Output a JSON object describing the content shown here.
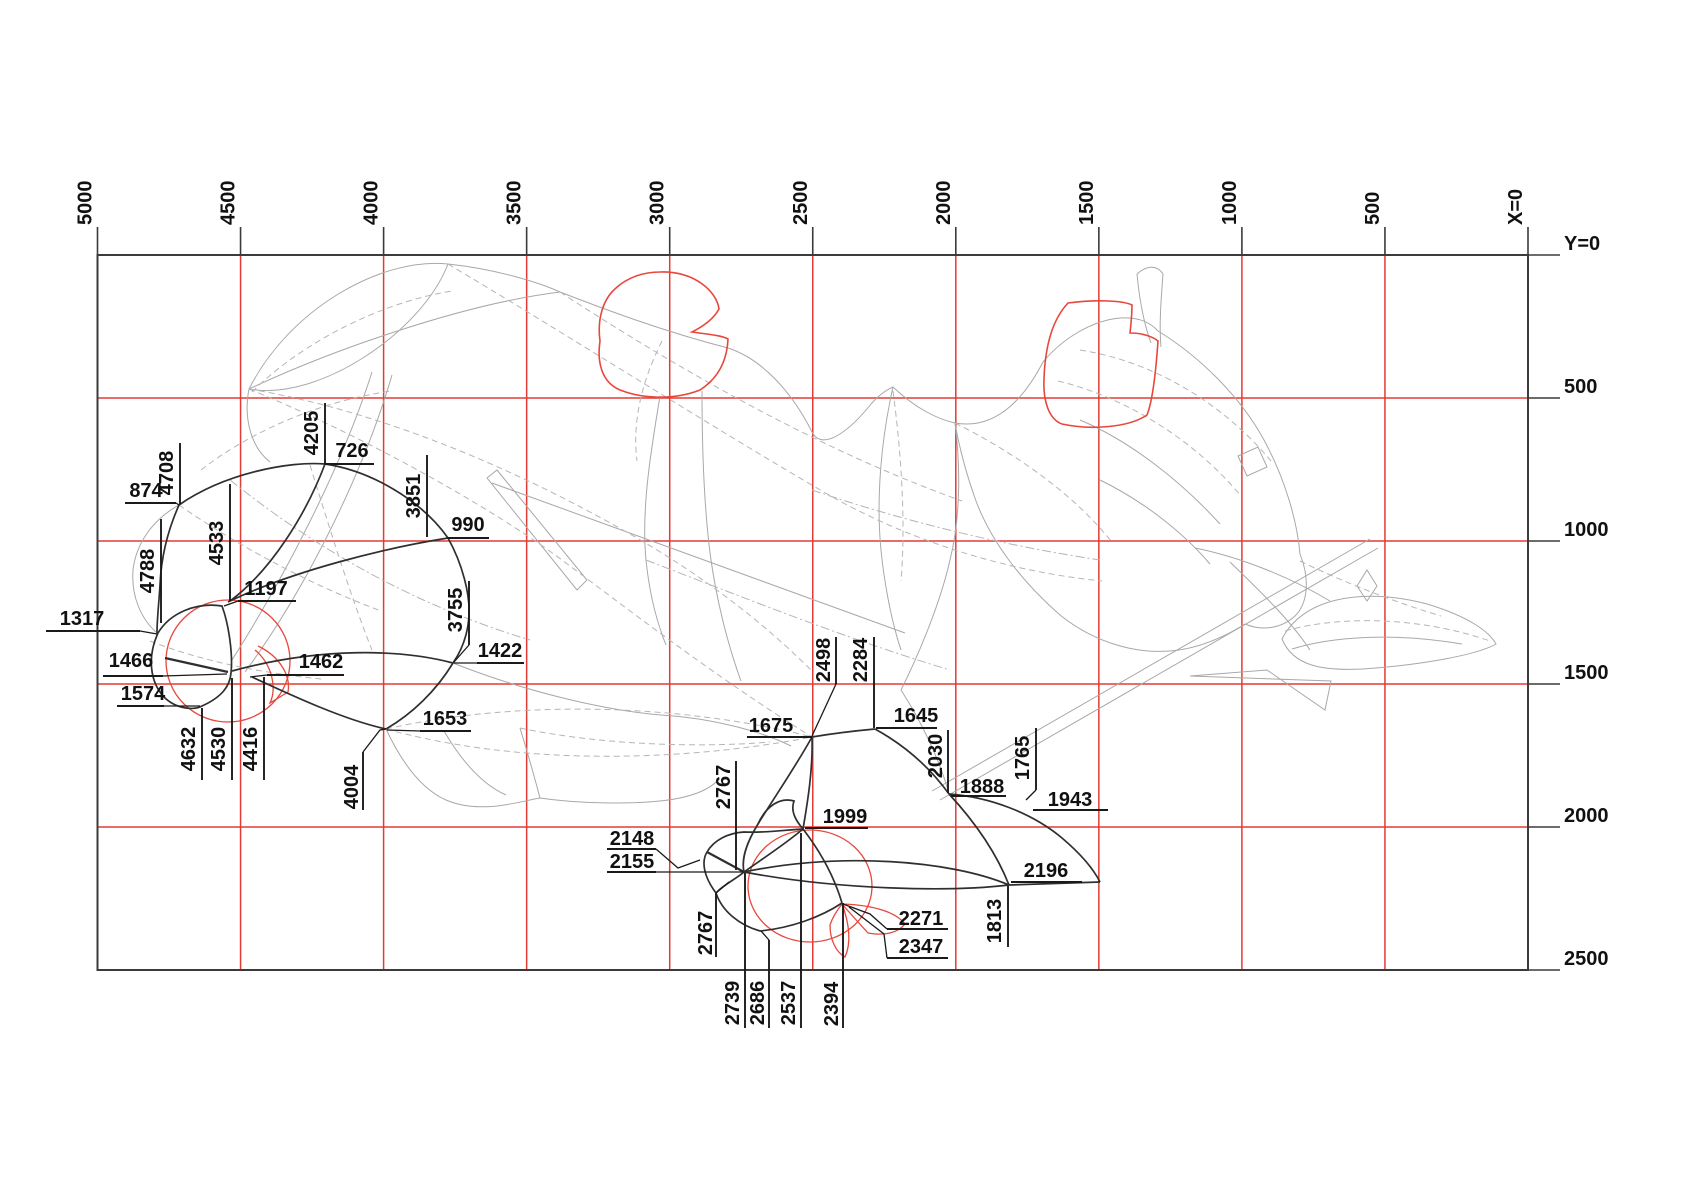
{
  "title": "CAD wireframe dimension drawing of reclining bull sculpture with coordinate grid",
  "axes": {
    "x_axis": {
      "zero_label": "X=0",
      "ticks": [
        "5000",
        "4500",
        "4000",
        "3500",
        "3000",
        "2500",
        "2000",
        "1500",
        "1000",
        "500",
        "X=0"
      ]
    },
    "y_axis": {
      "zero_label": "Y=0",
      "ticks": [
        "Y=0",
        "500",
        "1000",
        "1500",
        "2000",
        "2500"
      ]
    }
  },
  "grid": {
    "cols": 10,
    "rows": 5,
    "origin_x": 97.5,
    "origin_y": 255,
    "cell_w": 143.05,
    "cell_h": 143,
    "red_cells": [
      [
        1,
        0
      ],
      [
        3,
        0
      ],
      [
        5,
        0
      ],
      [
        7,
        0
      ],
      [
        9,
        0
      ],
      [
        0,
        1
      ],
      [
        2,
        1
      ],
      [
        4,
        1
      ],
      [
        6,
        1
      ],
      [
        8,
        1
      ],
      [
        1,
        2
      ],
      [
        3,
        2
      ],
      [
        5,
        2
      ],
      [
        7,
        2
      ],
      [
        9,
        2
      ],
      [
        0,
        3
      ],
      [
        2,
        3
      ],
      [
        4,
        3
      ],
      [
        6,
        3
      ],
      [
        8,
        3
      ],
      [
        1,
        4
      ],
      [
        3,
        4
      ],
      [
        5,
        4
      ],
      [
        7,
        4
      ],
      [
        9,
        4
      ]
    ]
  },
  "colors": {
    "grid_red": "#e23b35",
    "shape_red": "#e8473c",
    "axis_dark": "#3b3b3b",
    "wire_gray": "#a8a8a8",
    "wire_light": "#b5b5b5",
    "curve_dark": "#2f2f2f",
    "label_ink": "#111111"
  },
  "dimension_labels": [
    {
      "t": "4205",
      "x": 312,
      "y": 433,
      "r": 1,
      "ul": [
        325,
        403,
        325,
        464
      ],
      "ldr": []
    },
    {
      "t": "726",
      "x": 352,
      "y": 451,
      "r": 0,
      "ul": [
        325,
        464,
        374,
        464
      ],
      "ldr": []
    },
    {
      "t": "4708",
      "x": 167,
      "y": 473,
      "r": 1,
      "ul": [
        180,
        443,
        180,
        504
      ],
      "ldr": []
    },
    {
      "t": "874",
      "x": 146,
      "y": 491,
      "r": 0,
      "ul": [
        125,
        503,
        176,
        503
      ],
      "ldr": [
        [
          176,
          503
        ],
        [
          179,
          505
        ]
      ]
    },
    {
      "t": "3851",
      "x": 414,
      "y": 496,
      "r": 1,
      "ul": [
        427,
        455,
        427,
        537
      ],
      "ldr": []
    },
    {
      "t": "990",
      "x": 468,
      "y": 525,
      "r": 0,
      "ul": [
        447,
        538,
        489,
        538
      ],
      "ldr": []
    },
    {
      "t": "4533",
      "x": 217,
      "y": 543,
      "r": 1,
      "ul": [
        230,
        484,
        230,
        601
      ],
      "ldr": []
    },
    {
      "t": "4788",
      "x": 148,
      "y": 571,
      "r": 1,
      "ul": [
        161,
        519,
        161,
        623
      ],
      "ldr": []
    },
    {
      "t": "1197",
      "x": 266,
      "y": 589,
      "r": 0,
      "ul": [
        238,
        601,
        296,
        601
      ],
      "ldr": [
        [
          238,
          601
        ],
        [
          224,
          606
        ]
      ]
    },
    {
      "t": "3755",
      "x": 456,
      "y": 610,
      "r": 1,
      "ul": [
        469,
        581,
        469,
        645
      ],
      "ldr": [
        [
          469,
          645
        ],
        [
          454,
          662
        ]
      ]
    },
    {
      "t": "1317",
      "x": 82,
      "y": 619,
      "r": 0,
      "ul": [
        46,
        631,
        140,
        631
      ],
      "ldr": [
        [
          140,
          631
        ],
        [
          157,
          634
        ]
      ]
    },
    {
      "t": "1422",
      "x": 500,
      "y": 651,
      "r": 0,
      "ul": [
        477,
        663,
        524,
        663
      ],
      "ldr": [
        [
          477,
          663
        ],
        [
          454,
          663
        ]
      ]
    },
    {
      "t": "1466",
      "x": 131,
      "y": 661,
      "r": 0,
      "ul": [
        103,
        676,
        163,
        676
      ],
      "ldr": [
        [
          163,
          676
        ],
        [
          227,
          674
        ]
      ]
    },
    {
      "t": "1462",
      "x": 321,
      "y": 662,
      "r": 0,
      "ul": [
        267,
        675,
        344,
        675
      ],
      "ldr": [
        [
          267,
          675
        ],
        [
          250,
          677
        ]
      ]
    },
    {
      "t": "1574",
      "x": 143,
      "y": 694,
      "r": 0,
      "ul": [
        117,
        706,
        164,
        706
      ],
      "ldr": [
        [
          164,
          706
        ],
        [
          200,
          706
        ]
      ]
    },
    {
      "t": "1653",
      "x": 445,
      "y": 719,
      "r": 0,
      "ul": [
        420,
        731,
        471,
        731
      ],
      "ldr": [
        [
          420,
          731
        ],
        [
          387,
          730
        ]
      ]
    },
    {
      "t": "4632",
      "x": 189,
      "y": 749,
      "r": 1,
      "ul": [
        202,
        708,
        202,
        780
      ],
      "ldr": []
    },
    {
      "t": "4530",
      "x": 219,
      "y": 749,
      "r": 1,
      "ul": [
        232,
        678,
        232,
        780
      ],
      "ldr": []
    },
    {
      "t": "4416",
      "x": 251,
      "y": 749,
      "r": 1,
      "ul": [
        264,
        677,
        264,
        780
      ],
      "ldr": []
    },
    {
      "t": "4004",
      "x": 352,
      "y": 787,
      "r": 1,
      "ul": [
        363,
        752,
        363,
        810
      ],
      "ldr": [
        [
          363,
          752
        ],
        [
          380,
          730
        ],
        [
          386,
          729
        ]
      ]
    },
    {
      "t": "2498",
      "x": 824,
      "y": 660,
      "r": 1,
      "ul": [
        836,
        637,
        836,
        684
      ],
      "ldr": [
        [
          836,
          684
        ],
        [
          812,
          736
        ]
      ]
    },
    {
      "t": "2284",
      "x": 861,
      "y": 660,
      "r": 1,
      "ul": [
        874,
        637,
        874,
        728
      ],
      "ldr": []
    },
    {
      "t": "1675",
      "x": 771,
      "y": 726,
      "r": 0,
      "ul": [
        747,
        737,
        812,
        737
      ],
      "ldr": []
    },
    {
      "t": "1645",
      "x": 916,
      "y": 716,
      "r": 0,
      "ul": [
        876,
        728,
        937,
        728
      ],
      "ldr": []
    },
    {
      "t": "2030",
      "x": 936,
      "y": 756,
      "r": 1,
      "ul": [
        948,
        730,
        948,
        793
      ],
      "ldr": []
    },
    {
      "t": "1765",
      "x": 1023,
      "y": 758,
      "r": 1,
      "ul": [
        1036,
        728,
        1036,
        790
      ],
      "ldr": [
        [
          1036,
          790
        ],
        [
          1026,
          800
        ]
      ]
    },
    {
      "t": "2767",
      "x": 724,
      "y": 787,
      "r": 1,
      "ul": [
        736,
        761,
        736,
        870
      ],
      "ldr": []
    },
    {
      "t": "1888",
      "x": 982,
      "y": 787,
      "r": 0,
      "ul": [
        951,
        796,
        1006,
        796
      ],
      "ldr": []
    },
    {
      "t": "1943",
      "x": 1070,
      "y": 800,
      "r": 0,
      "ul": [
        1033,
        810,
        1108,
        810
      ],
      "ldr": []
    },
    {
      "t": "1999",
      "x": 845,
      "y": 817,
      "r": 0,
      "ul": [
        805,
        828,
        868,
        828
      ],
      "ldr": []
    },
    {
      "t": "2148",
      "x": 632,
      "y": 839,
      "r": 0,
      "ul": [
        607,
        849,
        656,
        849
      ],
      "ldr": [
        [
          656,
          849
        ],
        [
          678,
          868
        ],
        [
          700,
          860
        ]
      ]
    },
    {
      "t": "2155",
      "x": 632,
      "y": 862,
      "r": 0,
      "ul": [
        607,
        872,
        656,
        872
      ],
      "ldr": [
        [
          656,
          872
        ],
        [
          743,
          872
        ]
      ]
    },
    {
      "t": "2196",
      "x": 1046,
      "y": 871,
      "r": 0,
      "ul": [
        1011,
        882,
        1082,
        882
      ],
      "ldr": []
    },
    {
      "t": "2271",
      "x": 921,
      "y": 919,
      "r": 0,
      "ul": [
        887,
        929,
        948,
        929
      ],
      "ldr": [
        [
          887,
          929
        ],
        [
          870,
          914
        ],
        [
          843,
          904
        ]
      ]
    },
    {
      "t": "1813",
      "x": 995,
      "y": 921,
      "r": 1,
      "ul": [
        1008,
        886,
        1008,
        947
      ],
      "ldr": []
    },
    {
      "t": "2347",
      "x": 921,
      "y": 947,
      "r": 0,
      "ul": [
        887,
        958,
        948,
        958
      ],
      "ldr": [
        [
          887,
          958
        ],
        [
          884,
          934
        ],
        [
          849,
          907
        ]
      ]
    },
    {
      "t": "2767",
      "x": 706,
      "y": 933,
      "r": 1,
      "ul": [
        716,
        893,
        716,
        957
      ],
      "ldr": [
        [
          716,
          893
        ],
        [
          729,
          882
        ]
      ]
    },
    {
      "t": "2739",
      "x": 733,
      "y": 1003,
      "r": 1,
      "ul": [
        745,
        873,
        745,
        1028
      ],
      "ldr": []
    },
    {
      "t": "2686",
      "x": 758,
      "y": 1003,
      "r": 1,
      "ul": [
        769,
        940,
        769,
        1028
      ],
      "ldr": [
        [
          769,
          940
        ],
        [
          761,
          931
        ]
      ]
    },
    {
      "t": "2537",
      "x": 789,
      "y": 1003,
      "r": 1,
      "ul": [
        801,
        833,
        801,
        1028
      ],
      "ldr": []
    },
    {
      "t": "2394",
      "x": 832,
      "y": 1004,
      "r": 1,
      "ul": [
        843,
        903,
        843,
        1028
      ],
      "ldr": []
    }
  ]
}
